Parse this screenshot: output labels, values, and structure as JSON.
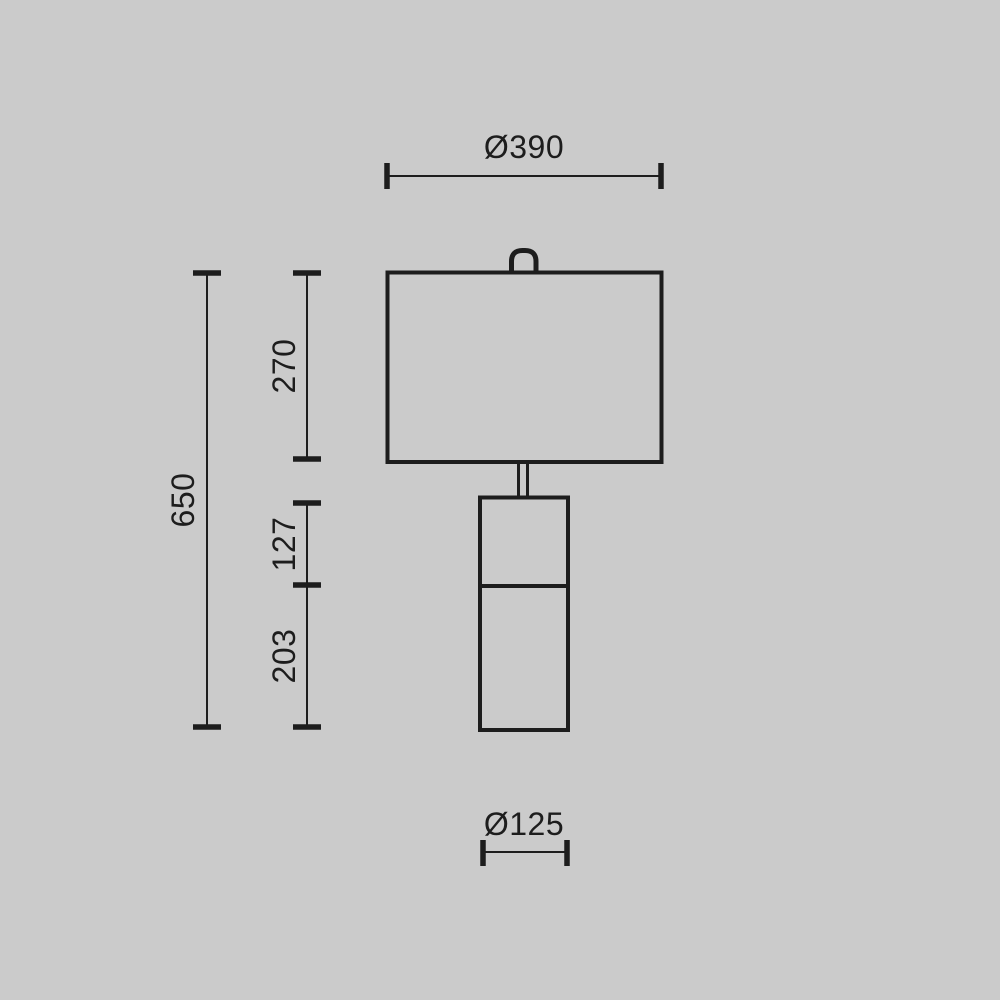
{
  "canvas": {
    "background_color": "#cbcbcb",
    "line_color": "#1d1d1d"
  },
  "drawing": {
    "subject": "table-lamp-technical-dimension-drawing",
    "dimensions": {
      "shade_diameter": {
        "label": "Ø390",
        "value": 390,
        "orientation": "horizontal",
        "location": "top"
      },
      "total_height": {
        "label": "650",
        "value": 650,
        "orientation": "vertical",
        "location": "left-outer"
      },
      "shade_height": {
        "label": "270",
        "value": 270,
        "orientation": "vertical",
        "location": "left-inner"
      },
      "upper_body_height": {
        "label": "127",
        "value": 127,
        "orientation": "vertical",
        "location": "left-inner"
      },
      "lower_body_height": {
        "label": "203",
        "value": 203,
        "orientation": "vertical",
        "location": "left-inner"
      },
      "base_diameter": {
        "label": "Ø125",
        "value": 125,
        "orientation": "horizontal",
        "location": "bottom"
      }
    }
  }
}
